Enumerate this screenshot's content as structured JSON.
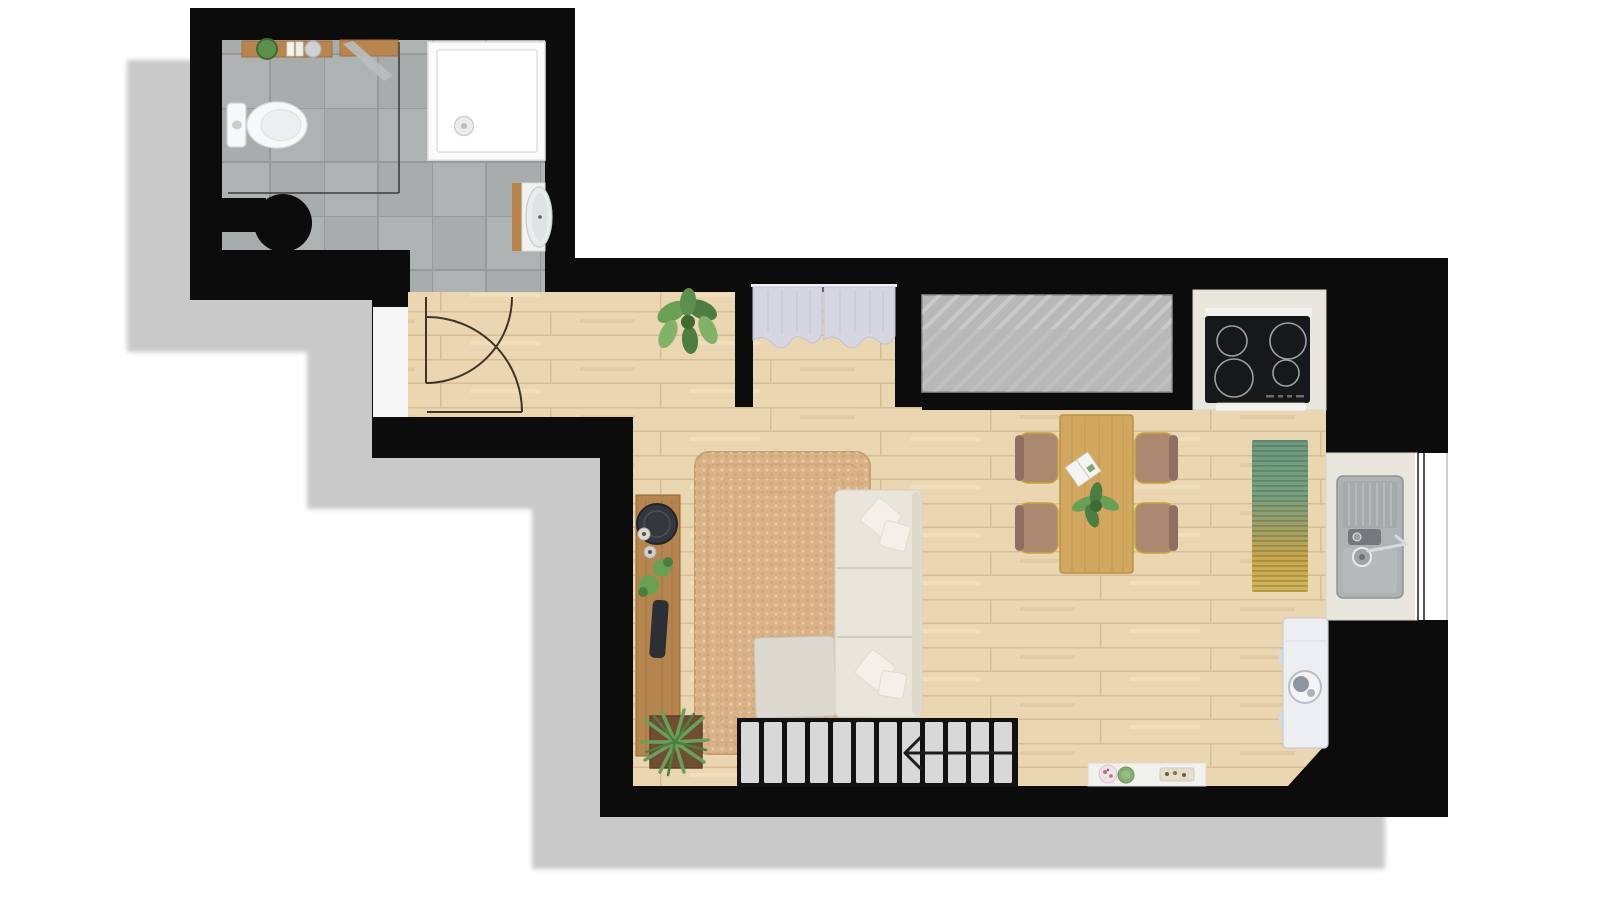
{
  "title": "studio-apartment-floor-plan",
  "colors": {
    "page_bg": "#ffffff",
    "shadow": "#c9c9c9",
    "wall": "#0c0c0c",
    "wood_floor": "#ead6b1",
    "wood_line": "#d6bd95",
    "tile_floor": "#a8acad",
    "tile_alt": "#aeb2b3",
    "tile_line": "#959a9c",
    "counter": "#e9e6dd",
    "cooktop": "#17181a",
    "burner_ring": "#9aa0a3",
    "sink_steel": "#aeb2b3",
    "sink_dark": "#75797b",
    "window_white": "#ffffff",
    "void_panel": "#b8b8b8",
    "curtain": "#d6d6e2",
    "rug_jute": "#d9b287",
    "sofa": "#e9e5da",
    "pillow": "#f2f0e9",
    "ottoman": "#dcd9d0",
    "console_wood": "#b5854f",
    "table_wood": "#d2a75f",
    "chair_seat": "#ac8871",
    "chair_back": "#8d6f63",
    "chair_frame": "#c9a23c",
    "runner_green": "#5f8f75",
    "runner_olive": "#9aa06a",
    "runner_gold": "#d4b45a",
    "stair_tread": "#d8d8d8",
    "stair_base": "#121212",
    "plant_green": "#69a054",
    "plant_dark": "#4e7d42",
    "appliance_white": "#eceef2",
    "fixture_white": "#f7f8f9",
    "shower_tray": "#fbfbfb",
    "wood_shelf": "#b9854f",
    "door_line": "#3f3428"
  },
  "objects": [
    "building-shadow",
    "exterior-walls",
    "bathroom-tile-floor",
    "toilet",
    "bathroom-shelf",
    "bathroom-bench-towel",
    "walk-in-shower-screen",
    "shower-tray",
    "laundry-basket",
    "washbasin-vanity",
    "hallway-tile",
    "entry-door-panel",
    "entry-door-swing",
    "bathroom-door-swing",
    "wardrobe-curtain-niche",
    "void-hatched-panel",
    "kitchen-counter",
    "induction-cooktop",
    "kitchen-sink-counter",
    "kitchen-sink",
    "kitchen-window",
    "runner-rug",
    "water-heater",
    "dining-table",
    "dining-chair",
    "table-plant",
    "magazine",
    "jute-area-rug",
    "sectional-sofa",
    "sofa-pillow",
    "ottoman",
    "media-console",
    "console-decor",
    "potted-plant-entry",
    "potted-plant-floor",
    "staircase",
    "stair-direction-arrow",
    "wall-shelf-dishes"
  ]
}
